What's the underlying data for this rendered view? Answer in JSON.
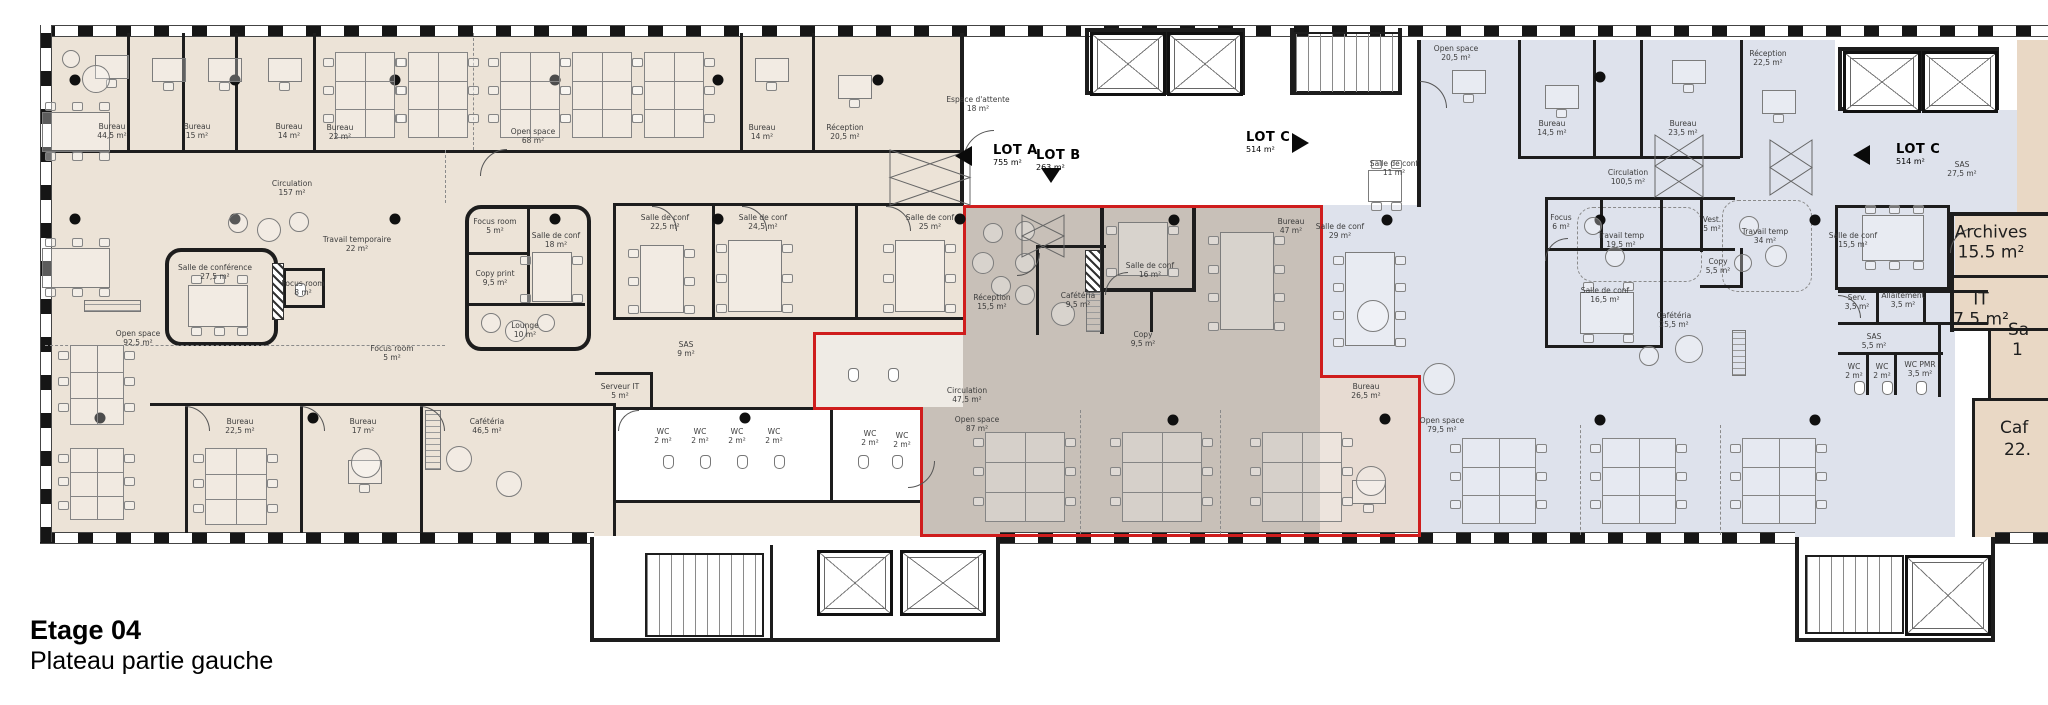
{
  "title": {
    "line1": "Etage 04",
    "line2": "Plateau partie gauche"
  },
  "lot_markers": [
    {
      "id": "lotA",
      "name": "LOT A",
      "area": "755 m²",
      "arrow": "left"
    },
    {
      "id": "lotB",
      "name": "LOT B",
      "area": "263 m²",
      "arrow": "down"
    },
    {
      "id": "lotC1",
      "name": "LOT C",
      "area": "514 m²",
      "arrow": "right"
    },
    {
      "id": "lotC2",
      "name": "LOT C",
      "area": "514 m²",
      "arrow": "left"
    }
  ],
  "rooms": [
    {
      "id": "a1",
      "label": "Bureau",
      "area": "44,5 m²"
    },
    {
      "id": "a2",
      "label": "Bureau",
      "area": "15 m²"
    },
    {
      "id": "a3",
      "label": "Bureau",
      "area": "14 m²"
    },
    {
      "id": "a4",
      "label": "Bureau",
      "area": "22 m²"
    },
    {
      "id": "a5",
      "label": "Open space",
      "area": "68 m²"
    },
    {
      "id": "a6",
      "label": "Bureau",
      "area": "14 m²"
    },
    {
      "id": "a7",
      "label": "Réception",
      "area": "20,5 m²"
    },
    {
      "id": "a8",
      "label": "Circulation",
      "area": "157 m²"
    },
    {
      "id": "a9",
      "label": "Travail temporaire",
      "area": "22 m²"
    },
    {
      "id": "a10",
      "label": "Salle de conférence",
      "area": "27,5 m²"
    },
    {
      "id": "a11",
      "label": "Focus room",
      "area": "8 m²"
    },
    {
      "id": "a12",
      "label": "Focus room",
      "area": "5 m²"
    },
    {
      "id": "a13",
      "label": "Salle de conf",
      "area": "18 m²"
    },
    {
      "id": "a14",
      "label": "Copy print",
      "area": "9,5 m²"
    },
    {
      "id": "a15",
      "label": "Open space",
      "area": "92,5 m²"
    },
    {
      "id": "a16",
      "label": "Lounge",
      "area": "10 m²"
    },
    {
      "id": "a17",
      "label": "Salle de conf",
      "area": "22,5 m²"
    },
    {
      "id": "a18",
      "label": "Salle de conf",
      "area": "24,5 m²"
    },
    {
      "id": "a19",
      "label": "Salle de conf",
      "area": "25 m²"
    },
    {
      "id": "a20",
      "label": "SAS",
      "area": "9 m²"
    },
    {
      "id": "a21",
      "label": "Serveur IT",
      "area": "5 m²"
    },
    {
      "id": "a22",
      "label": "Focus room",
      "area": "5 m²"
    },
    {
      "id": "a23",
      "label": "Bureau",
      "area": "22,5 m²"
    },
    {
      "id": "a24",
      "label": "Bureau",
      "area": "17 m²"
    },
    {
      "id": "a25",
      "label": "Cafétéria",
      "area": "46,5 m²"
    },
    {
      "id": "a26",
      "label": "WC",
      "area": "2 m²"
    },
    {
      "id": "a27",
      "label": "WC",
      "area": "2 m²"
    },
    {
      "id": "a28",
      "label": "WC",
      "area": "2 m²"
    },
    {
      "id": "a29",
      "label": "WC",
      "area": "2 m²"
    },
    {
      "id": "a30",
      "label": "WC",
      "area": "2 m²"
    },
    {
      "id": "a31",
      "label": "WC",
      "area": "2 m²"
    },
    {
      "id": "b1",
      "label": "Réception",
      "area": "15,5 m²"
    },
    {
      "id": "b2",
      "label": "Cafétéria",
      "area": "9,5 m²"
    },
    {
      "id": "b3",
      "label": "Salle de conf",
      "area": "16 m²"
    },
    {
      "id": "b4",
      "label": "Copy",
      "area": "9,5 m²"
    },
    {
      "id": "b5",
      "label": "Bureau",
      "area": "47 m²"
    },
    {
      "id": "b6",
      "label": "Circulation",
      "area": "47,5 m²"
    },
    {
      "id": "b7",
      "label": "Open space",
      "area": "87 m²"
    },
    {
      "id": "b8",
      "label": "Bureau",
      "area": "26,5 m²"
    },
    {
      "id": "c1",
      "label": "Open space",
      "area": "20,5 m²"
    },
    {
      "id": "c2",
      "label": "Bureau",
      "area": "14,5 m²"
    },
    {
      "id": "c3",
      "label": "Salle de conf",
      "area": "11 m²"
    },
    {
      "id": "c4",
      "label": "Bureau",
      "area": "23,5 m²"
    },
    {
      "id": "c5",
      "label": "Réception",
      "area": "22,5 m²"
    },
    {
      "id": "c6",
      "label": "Circulation",
      "area": "100,5 m²"
    },
    {
      "id": "c7",
      "label": "SAS",
      "area": "27,5 m²"
    },
    {
      "id": "c8",
      "label": "Travail temp",
      "area": "34 m²"
    },
    {
      "id": "c9",
      "label": "Salle de conf",
      "area": "15,5 m²"
    },
    {
      "id": "c10",
      "label": "Travail temp",
      "area": "19,5 m²"
    },
    {
      "id": "c11",
      "label": "Salle de conf",
      "area": "16,5 m²"
    },
    {
      "id": "c12",
      "label": "Focus",
      "area": "6 m²"
    },
    {
      "id": "c13",
      "label": "Vest.",
      "area": "5 m²"
    },
    {
      "id": "c14",
      "label": "Copy",
      "area": "5,5 m²"
    },
    {
      "id": "c15",
      "label": "Open space",
      "area": "79,5 m²"
    },
    {
      "id": "c16",
      "label": "Cafétéria",
      "area": "25,5 m²"
    },
    {
      "id": "c17",
      "label": "Salle de conf",
      "area": "29 m²"
    },
    {
      "id": "c18",
      "label": "Espace d'attente",
      "area": "18 m²"
    },
    {
      "id": "d1",
      "label": "Archives",
      "area": "15.5 m²",
      "emphasis": true
    },
    {
      "id": "d2",
      "label": "IT",
      "area": "7.5 m²",
      "emphasis": true
    },
    {
      "id": "d3",
      "label": "Serv.",
      "area": "3,5 m²"
    },
    {
      "id": "d4",
      "label": "Allaitement",
      "area": "3,5 m²"
    },
    {
      "id": "d5",
      "label": "SAS",
      "area": "5,5 m²"
    },
    {
      "id": "d6",
      "label": "WC",
      "area": "2 m²"
    },
    {
      "id": "d7",
      "label": "WC",
      "area": "2 m²"
    },
    {
      "id": "d8",
      "label": "WC PMR",
      "area": "3,5 m²"
    }
  ],
  "clipped_labels": [
    "Sa",
    "1",
    "Caf",
    "22."
  ],
  "colors": {
    "zoneA": "#ece3d7",
    "zoneB": "#c8c0b8",
    "zoneB_ext": "#efebe5",
    "zoneC": "#dee2ec",
    "zoneTan": "#e9d8c5",
    "zoneBureau265": "#e7dbd2",
    "lot_outline": "#cf1d1d",
    "wall": "#1d1d1d"
  }
}
